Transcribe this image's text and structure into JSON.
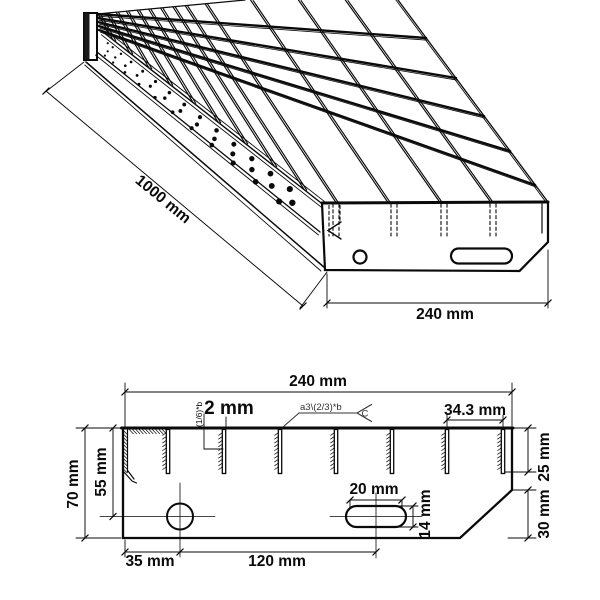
{
  "iso_view": {
    "length_dim": "1000 mm",
    "width_dim": "240 mm"
  },
  "section_view": {
    "width_dim": "240 mm",
    "bar_thickness_dim": "2 mm",
    "serration_note": "(1/6)*b",
    "weld_note": "a3\\(2/3)*b",
    "weld_tail": "C",
    "bar_spacing_dim": "34.3 mm",
    "bar_depth_dim": "25 mm",
    "chamfer_dim": "30 mm",
    "height_dim": "70 mm",
    "hole_height_dim": "55 mm",
    "slot_width_dim": "20 mm",
    "slot_height_dim": "14 mm",
    "hole_offset_dim": "35 mm",
    "slot_offset_dim": "120 mm"
  }
}
